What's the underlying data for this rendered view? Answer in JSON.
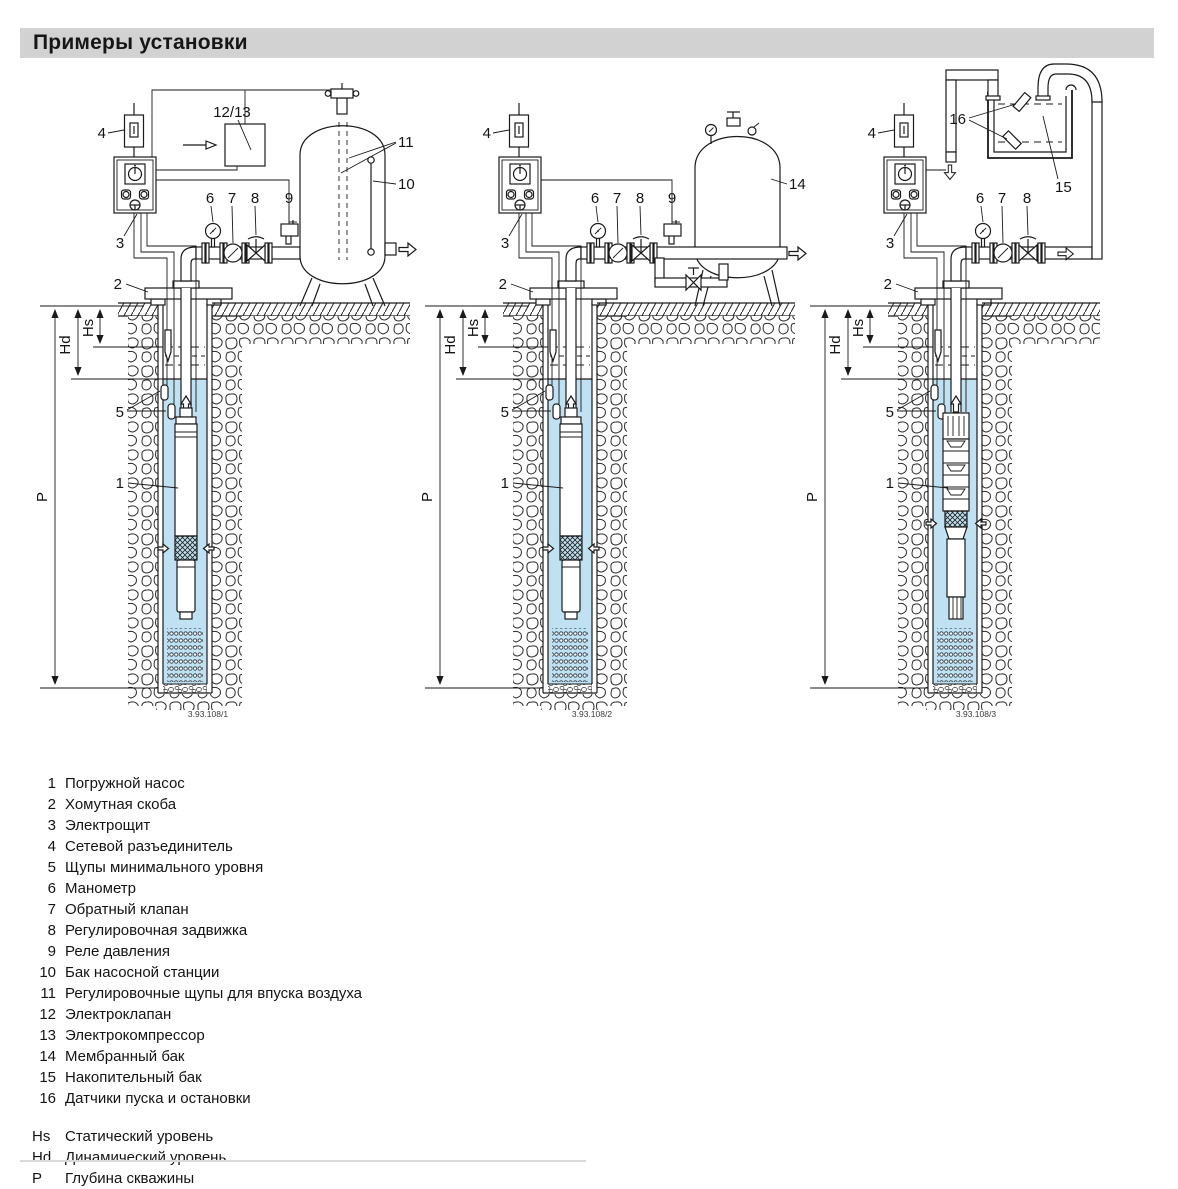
{
  "page": {
    "title": "Примеры установки"
  },
  "callouts": {
    "c1": "1",
    "c2": "2",
    "c3": "3",
    "c4": "4",
    "c5": "5",
    "c6": "6",
    "c7": "7",
    "c8": "8",
    "c9": "9",
    "c10": "10",
    "c11": "11",
    "c12_13": "12/13",
    "c14": "14",
    "c15": "15",
    "c16": "16",
    "hs": "Hs",
    "hd": "Hd",
    "p": "P"
  },
  "diagrams": [
    {
      "name": "well-with-pump-station-tank",
      "caption": "3.93.108/1"
    },
    {
      "name": "well-with-membrane-tank",
      "caption": "3.93.108/2"
    },
    {
      "name": "well-with-storage-tank",
      "caption": "3.93.108/3"
    }
  ],
  "legend": {
    "items": [
      {
        "num": "1",
        "text": "Погружной насос"
      },
      {
        "num": "2",
        "text": "Хомутная скоба"
      },
      {
        "num": "3",
        "text": "Электрощит"
      },
      {
        "num": "4",
        "text": "Сетевой разъединитель"
      },
      {
        "num": "5",
        "text": "Щупы минимального уровня"
      },
      {
        "num": "6",
        "text": "Манометр"
      },
      {
        "num": "7",
        "text": "Обратный клапан"
      },
      {
        "num": "8",
        "text": "Регулировочная задвижка"
      },
      {
        "num": "9",
        "text": "Реле давления"
      },
      {
        "num": "10",
        "text": "Бак насосной станции"
      },
      {
        "num": "11",
        "text": "Регулировочные щупы для впуска воздуха"
      },
      {
        "num": "12",
        "text": "Электроклапан"
      },
      {
        "num": "13",
        "text": "Электрокомпрессор"
      },
      {
        "num": "14",
        "text": "Мембранный бак"
      },
      {
        "num": "15",
        "text": "Накопительный бак"
      },
      {
        "num": "16",
        "text": "Датчики пуска и остановки"
      }
    ],
    "dims": [
      {
        "num": "Hs",
        "text": "Статический уровень"
      },
      {
        "num": "Hd",
        "text": "Динамический уровень"
      },
      {
        "num": "Р",
        "text": "Глубина скважины"
      }
    ]
  },
  "colors": {
    "water": "#bfe1f1",
    "title_bg": "#d2d2d2"
  }
}
